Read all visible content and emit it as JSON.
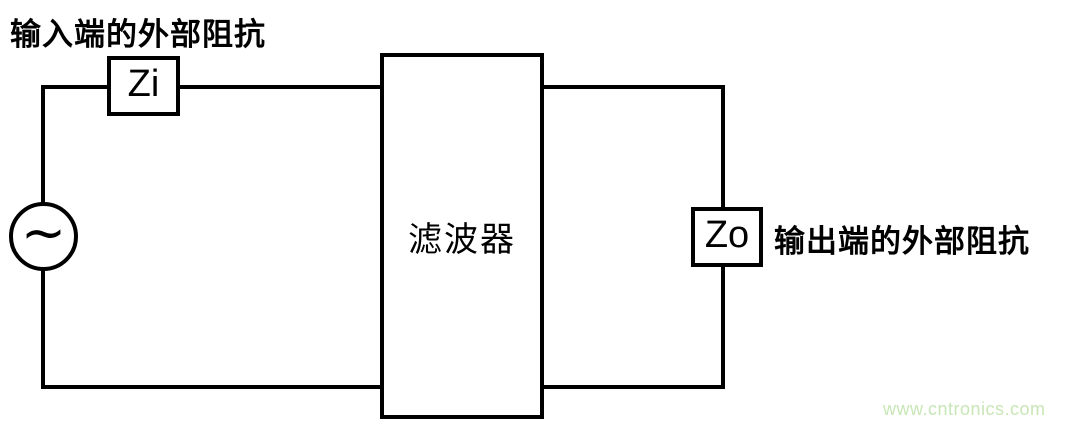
{
  "diagram": {
    "input_impedance_label": "输入端的外部阻抗",
    "source": {
      "symbol": "∼",
      "type": "ac-source"
    },
    "zi": {
      "label": "Zi"
    },
    "filter": {
      "label": "滤波器"
    },
    "zo": {
      "label": "Zo"
    },
    "output_impedance_label": "输出端的外部阻抗"
  },
  "watermark": {
    "text": "www.cntronics.com"
  },
  "colors": {
    "line": "#000000",
    "background": "#ffffff",
    "watermark": "#c8e6b6"
  }
}
